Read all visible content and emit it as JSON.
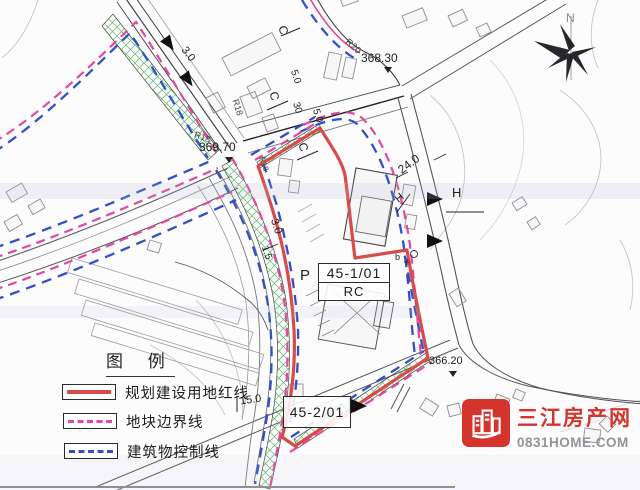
{
  "map": {
    "labels": [
      "368.30",
      "369.70",
      "366.20",
      "R20",
      "R18",
      "R18",
      "R18",
      "C",
      "C",
      "C",
      "5.0",
      "30",
      "5.0",
      "3.0",
      "24.0",
      "H",
      "H",
      "P",
      "b",
      "3.0",
      "1.5",
      "15.0",
      "N"
    ],
    "parcels": {
      "p1_code": "45-1/01",
      "p1_type": "RC",
      "p2_code": "45-2/01"
    }
  },
  "legend": {
    "title": "图  例",
    "items": [
      {
        "label": "规划建设用地红线",
        "swatch": "red-solid",
        "color": "#d94b4b"
      },
      {
        "label": "地块边界线",
        "swatch": "pink-dashed",
        "color": "#e3469f"
      },
      {
        "label": "建筑物控制线",
        "swatch": "blue-dashed",
        "color": "#3050c8"
      }
    ]
  },
  "logo": {
    "name": "三江房产网",
    "site": "0831HOME.COM",
    "color": "#d5342c"
  },
  "colors": {
    "red_line": "#d94b4b",
    "pink_line": "#e3469f",
    "blue_line": "#3050c8",
    "hatch_green": "#46b050"
  }
}
